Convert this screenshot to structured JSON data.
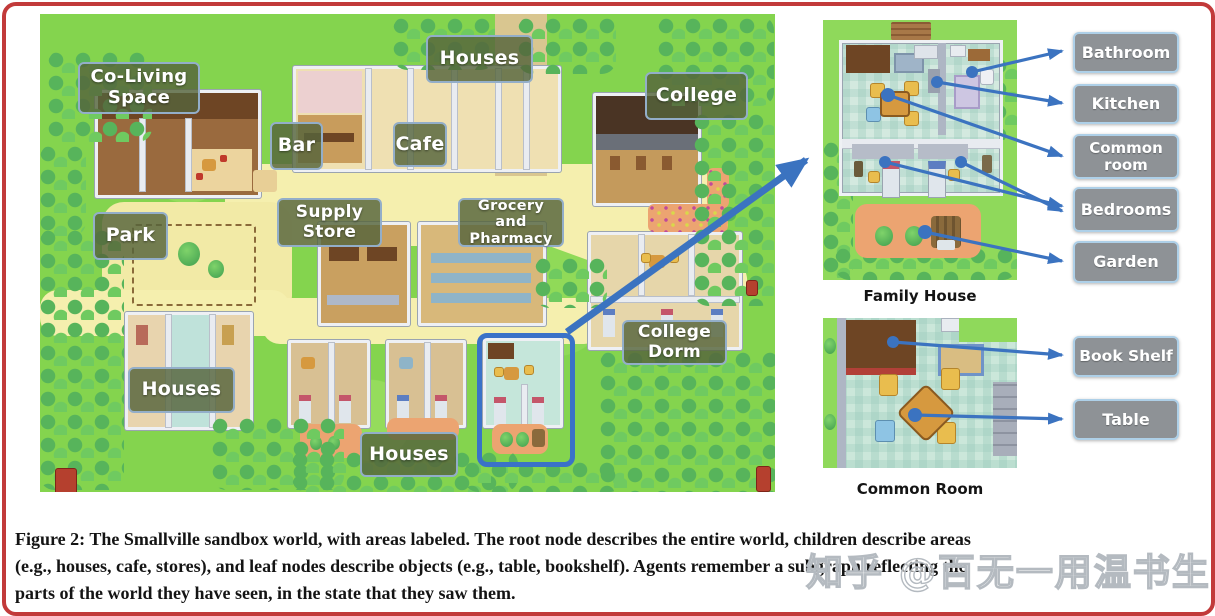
{
  "figure": {
    "map_labels": [
      "Co-Living Space",
      "Houses",
      "Bar",
      "Cafe",
      "College",
      "Supply Store",
      "Grocery and Pharmacy",
      "Park",
      "College Dorm",
      "Houses",
      "Houses"
    ],
    "family_house": {
      "caption": "Family House",
      "labels": [
        "Bathroom",
        "Kitchen",
        "Common room",
        "Bedrooms",
        "Garden"
      ]
    },
    "common_room": {
      "caption": "Common Room",
      "labels": [
        "Book Shelf",
        "Table"
      ]
    },
    "caption_lines": [
      "Figure 2: The Smallville sandbox world, with areas labeled. The root node describes the entire world, children describe areas",
      "(e.g., houses, cafe, stores), and leaf nodes describe objects (e.g., table, bookshelf). Agents remember a subgraph reflecting the",
      "parts of the world they have seen, in the state that they saw them."
    ],
    "watermark": "知乎 @百无一用温书生",
    "colors": {
      "frame_border": "#c23a3a",
      "map_label_bg": "#55643",
      "map_label_border": "#93aec9",
      "right_label_bg": "#8e9296",
      "right_label_border": "#aed0e8",
      "arrow_blue": "#3b73c0",
      "highlight_blue": "#3a72c8",
      "grass_green": "#84d44e",
      "road_yellow": "#f5efae",
      "garden_orange": "#eca471"
    }
  }
}
